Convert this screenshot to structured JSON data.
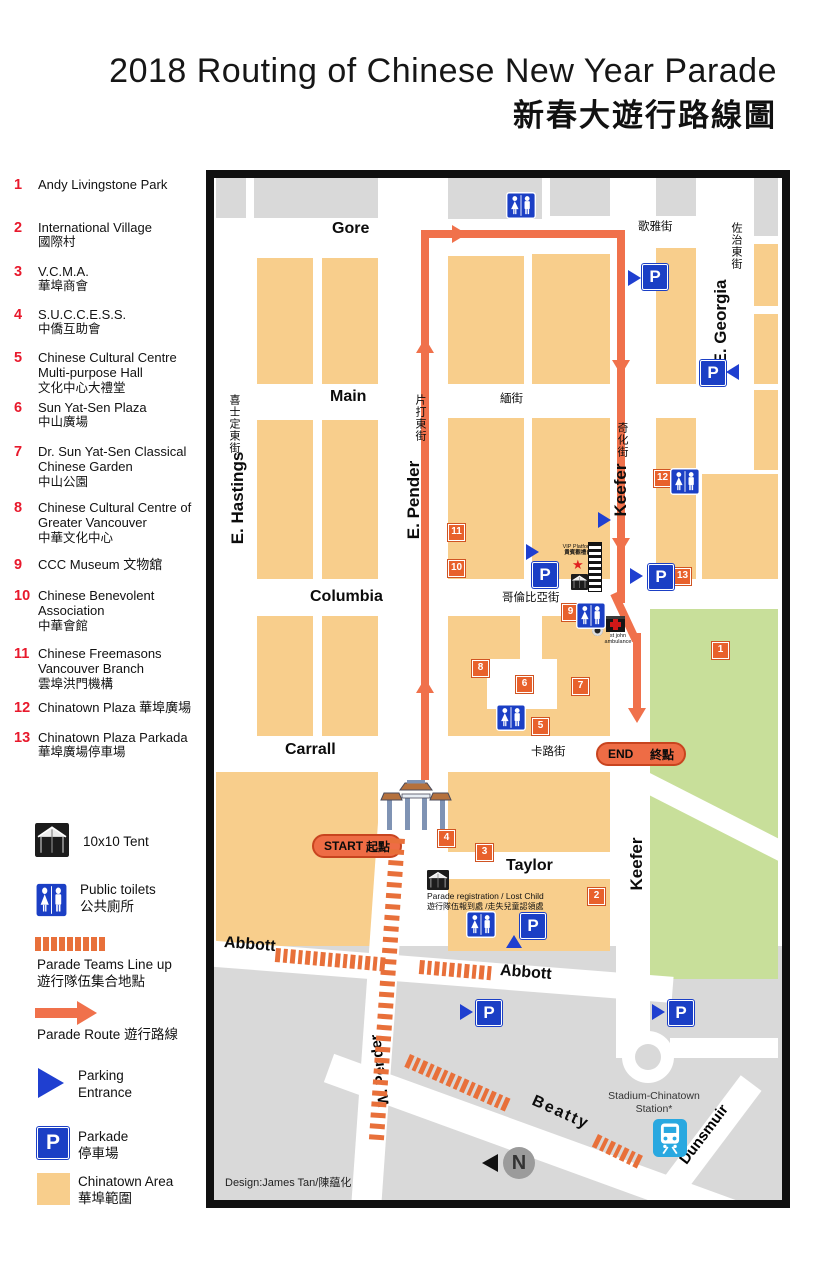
{
  "title": {
    "en": "2018 Routing of Chinese New Year Parade",
    "zh": "新春大遊行路線圖"
  },
  "legend": {
    "items": [
      {
        "num": "1",
        "en": "Andy Livingstone Park",
        "zh": ""
      },
      {
        "num": "2",
        "en": "International Village",
        "zh": "國際村"
      },
      {
        "num": "3",
        "en": "V.C.M.A.",
        "zh": "華埠商會"
      },
      {
        "num": "4",
        "en": "S.U.C.C.E.S.S.",
        "zh": "中僑互助會"
      },
      {
        "num": "5",
        "en": "Chinese Cultural Centre Multi-purpose Hall",
        "zh": "文化中心大禮堂"
      },
      {
        "num": "6",
        "en": "Sun Yat-Sen Plaza",
        "zh": "中山廣場"
      },
      {
        "num": "7",
        "en": "Dr. Sun Yat-Sen Classical Chinese Garden",
        "zh": "中山公園"
      },
      {
        "num": "8",
        "en": "Chinese Cultural Centre  of  Greater Vancouver",
        "zh": "中華文化中心"
      },
      {
        "num": "9",
        "en": "CCC Museum  文物舘",
        "zh": ""
      },
      {
        "num": "10",
        "en": "Chinese Benevolent Association",
        "zh": "中華會館"
      },
      {
        "num": "11",
        "en": "Chinese Freemasons Vancouver Branch",
        "zh": "雲埠洪門機構"
      },
      {
        "num": "12",
        "en": "Chinatown Plaza  華埠廣場",
        "zh": ""
      },
      {
        "num": "13",
        "en": "Chinatown Plaza  Parkada",
        "zh": "華埠廣場停車場"
      }
    ],
    "symbols": {
      "tent": "10x10 Tent",
      "toilets_en": "Public toilets",
      "toilets_zh": "公共廁所",
      "lineup_en": "Parade Teams Line up",
      "lineup_zh": "遊行隊伍集合地點",
      "route": "Parade Route 遊行路線",
      "parking1": "Parking",
      "parking2": "Entrance",
      "parkade_en": "Parkade",
      "parkade_zh": "停車場",
      "area_en": "Chinatown Area",
      "area_zh": "華埠範圍"
    }
  },
  "map": {
    "streets": {
      "gore": {
        "en": "Gore",
        "zh": "歌雅街"
      },
      "main": {
        "en": "Main",
        "zh": "緬街"
      },
      "columbia": {
        "en": "Columbia",
        "zh": "哥倫比亞街"
      },
      "carrall": {
        "en": "Carrall",
        "zh": "卡路街"
      },
      "taylor": "Taylor",
      "abbott": "Abbott",
      "hastings": {
        "en": "E. Hastings",
        "zh": "喜士定東街"
      },
      "pender": {
        "en": "E. Pender",
        "zh": "片打東街"
      },
      "keefer": {
        "en": "Keefer",
        "zh": "奇化街"
      },
      "georgia": {
        "en": "E. Georgia",
        "zh": "佐治東街"
      },
      "wpender": "W. Pender",
      "beatty": "Beatty",
      "dunsmuir": "Dunsmuir"
    },
    "route": {
      "start": "START",
      "start_zh": "起點",
      "end": "END",
      "end_zh": "終點"
    },
    "poi": {
      "vip_en": "VIP Platform",
      "vip_zh": "貴賓觀禮台",
      "stjohn1": "st john",
      "stjohn2": "ambulance",
      "registration_en": "Parade  registration / Lost Child",
      "registration_zh": "遊行隊伍報到處 /走失兒童認領處",
      "station1": "Stadium-Chinatown",
      "station2": "Station*"
    },
    "marker_numbers": [
      "1",
      "2",
      "3",
      "4",
      "5",
      "6",
      "7",
      "8",
      "9",
      "10",
      "11",
      "12",
      "13"
    ],
    "credit": "Design:James Tan/陳藴化"
  },
  "glyphs": {
    "p": "P",
    "n": "N",
    "star": "★"
  },
  "colors": {
    "chinatown_block": "#F8CE8C",
    "other_block": "#D9D9D9",
    "park": "#C8DF9A",
    "route_orange": "#F0714B",
    "lineup_orange": "#E8703A",
    "marker_orange": "#E8612C",
    "sign_blue": "#1B3FC5",
    "train_blue": "#29A8E0",
    "legend_red": "#E8192C"
  }
}
